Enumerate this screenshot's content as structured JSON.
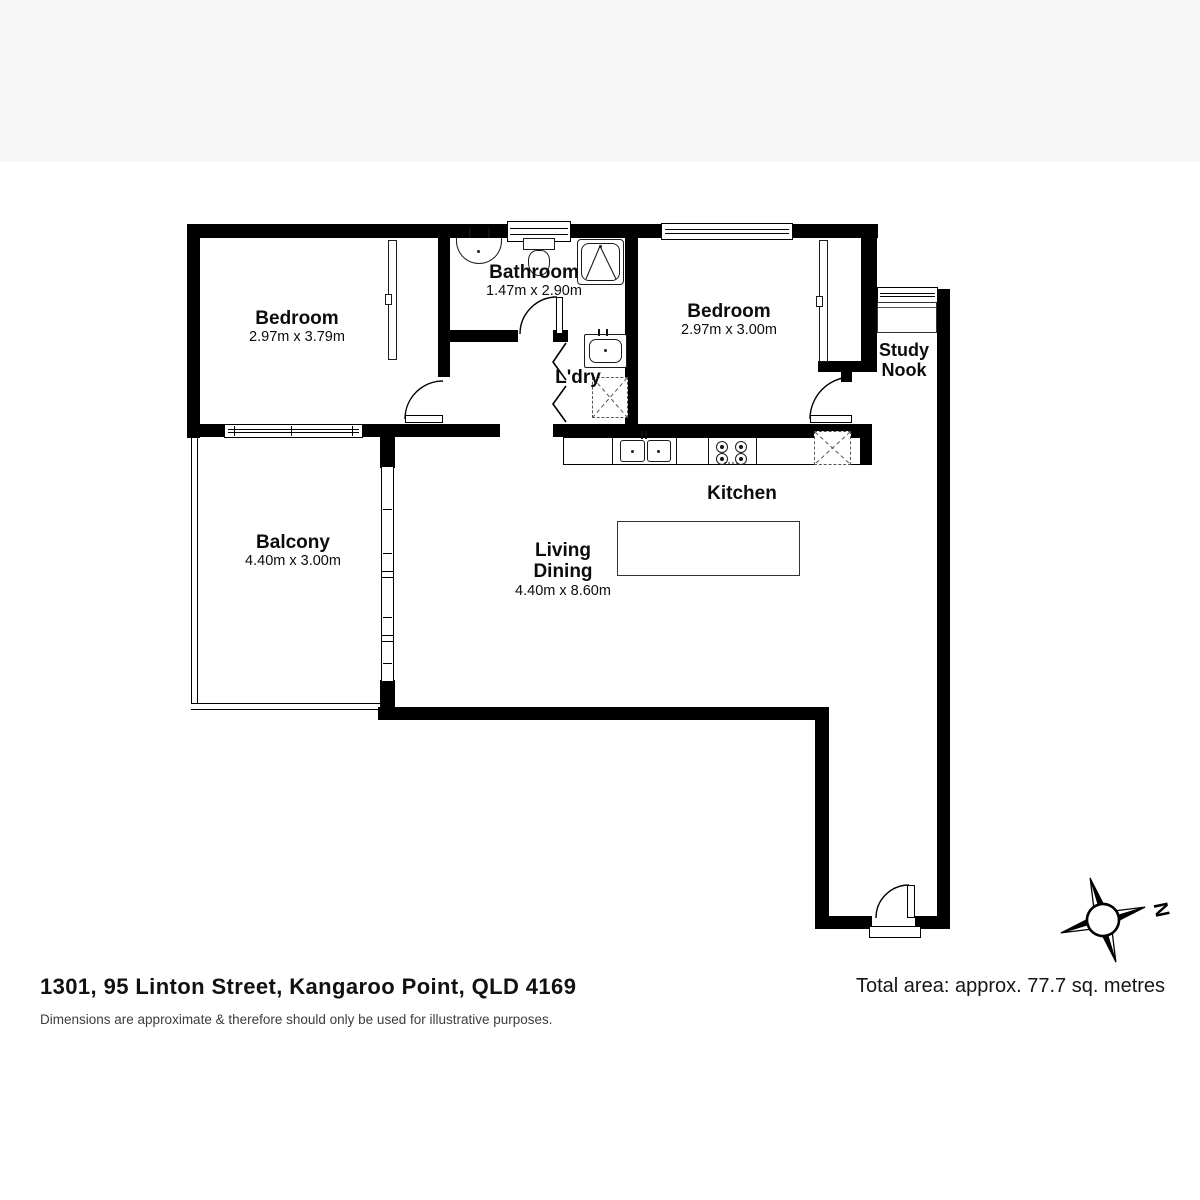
{
  "title_block": {
    "address": "1301, 95 Linton Street, Kangaroo Point, QLD 4169",
    "disclaimer": "Dimensions are approximate & therefore should only be used for illustrative purposes.",
    "total_area": "Total area: approx. 77.7 sq. metres"
  },
  "compass": {
    "label": "N"
  },
  "rooms": {
    "bedroom1": {
      "name": "Bedroom",
      "dims": "2.97m x 3.79m"
    },
    "bathroom": {
      "name": "Bathroom",
      "dims": "1.47m x 2.90m"
    },
    "bedroom2": {
      "name": "Bedroom",
      "dims": "2.97m x 3.00m"
    },
    "laundry": {
      "name": "L'dry"
    },
    "study_nook": {
      "line1": "Study",
      "line2": "Nook"
    },
    "kitchen": {
      "name": "Kitchen"
    },
    "living_dining": {
      "line1": "Living",
      "line2": "Dining",
      "dims": "4.40m x 8.60m"
    },
    "balcony": {
      "name": "Balcony",
      "dims": "4.40m x 3.00m"
    }
  },
  "symbols": {
    "bathroom": [
      "vanity-basin",
      "toilet",
      "shower"
    ],
    "laundry": [
      "laundry-tub",
      "washing-machine",
      "bifold-doors"
    ],
    "kitchen": [
      "double-sink",
      "cooktop",
      "refrigerator",
      "island-bench"
    ],
    "study_nook": [
      "desk",
      "window"
    ],
    "bedroom1": [
      "wardrobe",
      "door",
      "window"
    ],
    "bedroom2": [
      "wardrobe",
      "door",
      "window"
    ],
    "living": [
      "sliding-door"
    ],
    "balcony": [
      "railing"
    ],
    "entry": [
      "entry-door"
    ],
    "compass": [
      "compass-rose"
    ]
  }
}
